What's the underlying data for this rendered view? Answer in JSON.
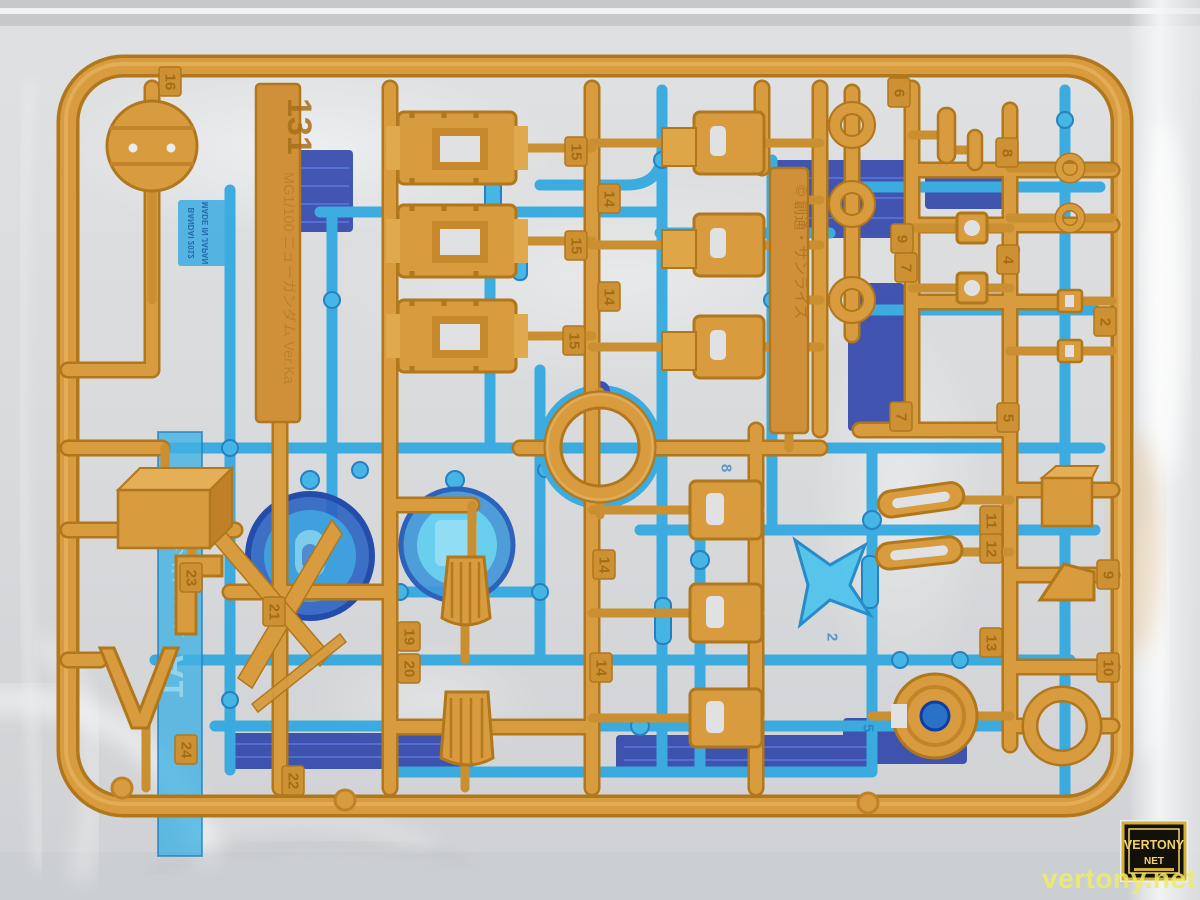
{
  "colors": {
    "bag_light": "#e4e6e8",
    "bag_base": "#d5d7da",
    "bag_dark": "#c7cacd",
    "orange_dark": "#b0771c",
    "orange_mid": "#d89b3e",
    "orange_light": "#eab967",
    "tab_orange": "#cd9134",
    "tab_orange_text": "#9e6a14",
    "blue_light": "#2aa6e0",
    "blue_mid": "#1f7fd0",
    "blue_deep": "#1f5fc0",
    "navy": "#2138a6",
    "tab_blue_text": "#0f6cb0",
    "watermark_yellow": "#eeeb67",
    "badge_gold": "#d4af37",
    "badge_black": "#121008"
  },
  "tags": {
    "runner_id": {
      "number": "131",
      "name": "MG1/100 ニューガンダム Ver.Ka"
    },
    "copyright": "© 創通・サンライズ",
    "blue_runner_id": "A1",
    "blue_runner_name": "ニューガンダム Ver.Ka",
    "mold_stamp_line1": "BANDAI 2012",
    "mold_stamp_line2": "MADE IN JAPAN"
  },
  "watermark": {
    "text": "vertony.net",
    "badge_top": "VERTONY",
    "badge_bottom": "NET"
  },
  "number_tabs": [
    {
      "n": "16",
      "x": 170,
      "y": 82
    },
    {
      "n": "15",
      "x": 576,
      "y": 152
    },
    {
      "n": "15",
      "x": 576,
      "y": 246
    },
    {
      "n": "15",
      "x": 574,
      "y": 341
    },
    {
      "n": "14",
      "x": 609,
      "y": 199
    },
    {
      "n": "14",
      "x": 609,
      "y": 297
    },
    {
      "n": "14",
      "x": 604,
      "y": 565
    },
    {
      "n": "14",
      "x": 601,
      "y": 668
    },
    {
      "n": "6",
      "x": 899,
      "y": 93
    },
    {
      "n": "9",
      "x": 902,
      "y": 239
    },
    {
      "n": "7",
      "x": 906,
      "y": 268
    },
    {
      "n": "7",
      "x": 901,
      "y": 417
    },
    {
      "n": "8",
      "x": 1007,
      "y": 153
    },
    {
      "n": "4",
      "x": 1008,
      "y": 260
    },
    {
      "n": "5",
      "x": 1008,
      "y": 418
    },
    {
      "n": "2",
      "x": 1105,
      "y": 322
    },
    {
      "n": "11",
      "x": 991,
      "y": 521
    },
    {
      "n": "12",
      "x": 991,
      "y": 549
    },
    {
      "n": "13",
      "x": 991,
      "y": 643
    },
    {
      "n": "9",
      "x": 1108,
      "y": 575
    },
    {
      "n": "10",
      "x": 1108,
      "y": 668
    },
    {
      "n": "19",
      "x": 409,
      "y": 637
    },
    {
      "n": "20",
      "x": 409,
      "y": 669
    },
    {
      "n": "21",
      "x": 274,
      "y": 612
    },
    {
      "n": "23",
      "x": 191,
      "y": 578
    },
    {
      "n": "24",
      "x": 186,
      "y": 750
    },
    {
      "n": "22",
      "x": 293,
      "y": 781
    }
  ],
  "blue_number_tabs": [
    {
      "n": "8",
      "x": 726,
      "y": 468
    },
    {
      "n": "2",
      "x": 832,
      "y": 637
    },
    {
      "n": "5",
      "x": 868,
      "y": 728
    },
    {
      "n": "3",
      "x": 625,
      "y": 413
    }
  ]
}
